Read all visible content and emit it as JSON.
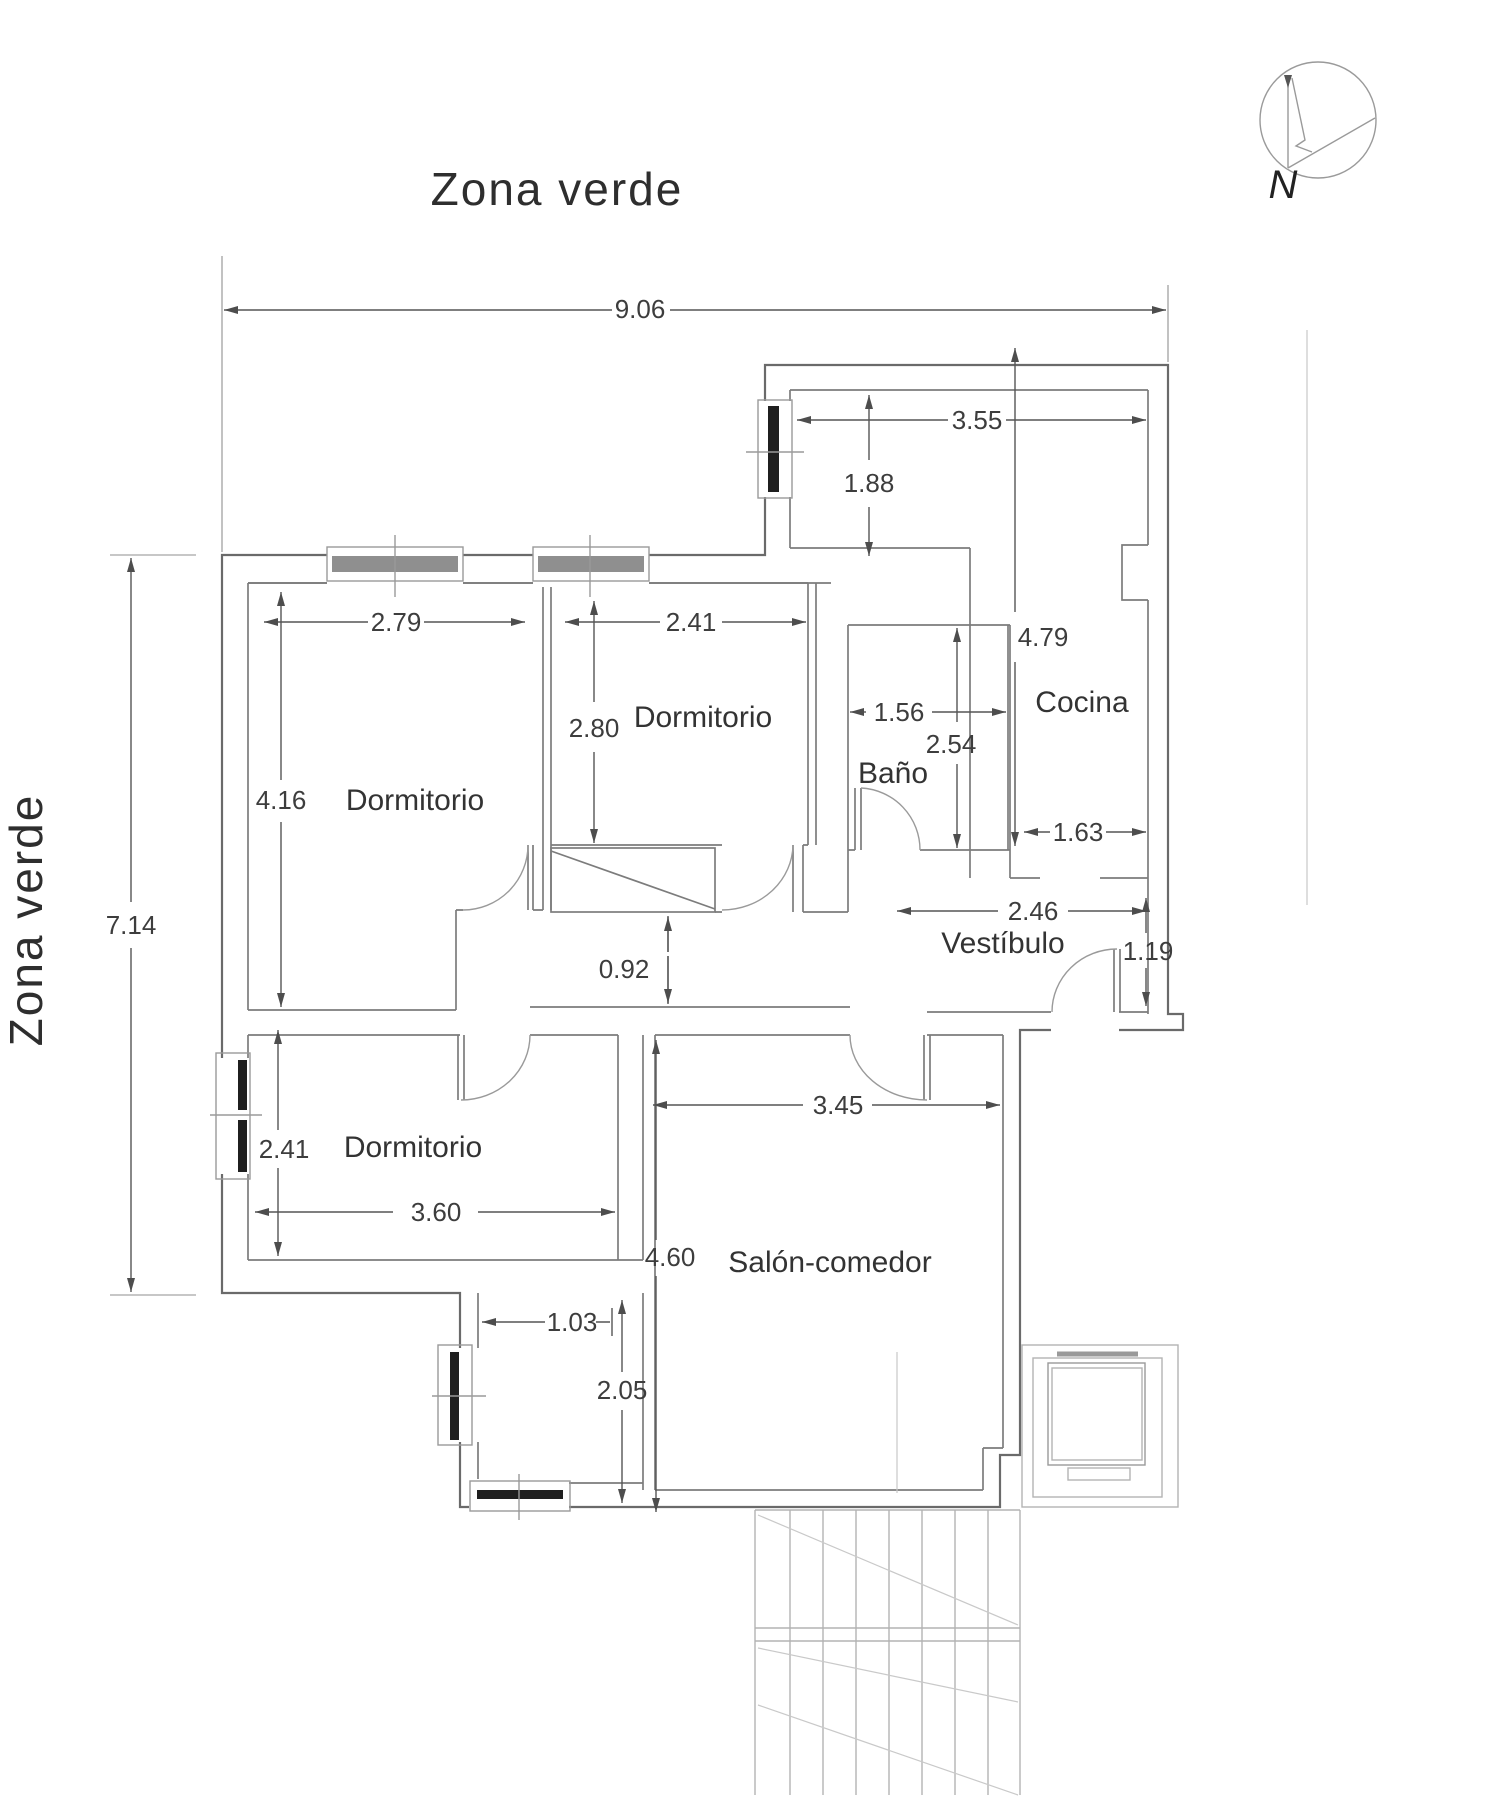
{
  "title": {
    "top": "Zona verde",
    "left": "Zona verde"
  },
  "compass": {
    "label": "N"
  },
  "rooms": {
    "dormitorio1": "Dormitorio",
    "dormitorio2": "Dormitorio",
    "dormitorio3": "Dormitorio",
    "bano": "Baño",
    "cocina": "Cocina",
    "vestibulo": "Vestíbulo",
    "salon": "Salón-comedor"
  },
  "dims": {
    "total_width": "9.06",
    "total_height": "7.14",
    "terraza_width": "3.55",
    "terraza_depth": "1.88",
    "cocina_height": "4.79",
    "cocina_width": "1.63",
    "dorm1_width": "2.79",
    "dorm1_height": "4.16",
    "dorm2_width": "2.41",
    "dorm2_height": "2.80",
    "bano_width": "1.56",
    "bano_height": "2.54",
    "pasillo": "0.92",
    "vestibulo": "2.46",
    "entrada": "1.19",
    "salon_width": "3.45",
    "salon_height": "4.60",
    "dorm3_height": "2.41",
    "dorm3_width": "3.60",
    "porche_width": "1.03",
    "porche_height": "2.05"
  }
}
